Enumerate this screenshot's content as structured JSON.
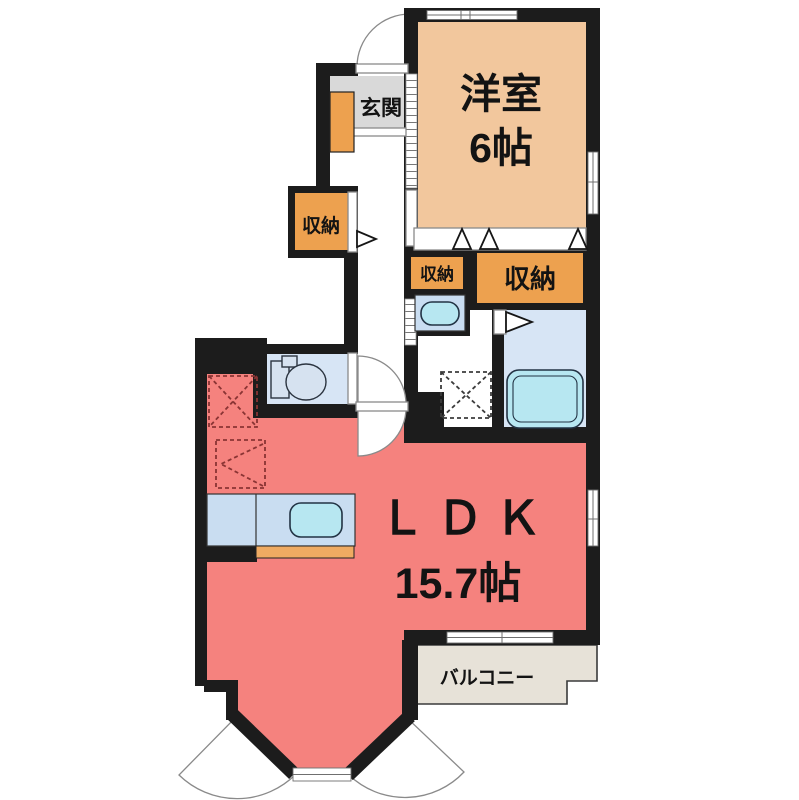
{
  "floorplan": {
    "rooms": {
      "bedroom": {
        "name": "洋室",
        "size": "6帖"
      },
      "ldk": {
        "name": "ＬＤＫ",
        "size": "15.7帖"
      },
      "entrance": {
        "label": "玄関"
      },
      "balcony": {
        "label": "バルコニー"
      },
      "closet_hall": {
        "label": "収納"
      },
      "closet_small": {
        "label": "収納"
      },
      "closet_wide": {
        "label": "収納"
      }
    },
    "colors": {
      "wall": "#1c1c1c",
      "bedroom_floor": "#f2c79d",
      "ldk_floor": "#f5827e",
      "closet": "#eda14f",
      "entrance_floor": "#d9d9d9",
      "balcony_floor": "#e7e2d8",
      "wet_floor": "#d7e5f5",
      "fixture_panel": "#c9ddf1",
      "fixture_water": "#b7e7f1",
      "counter_accent": "#efab62"
    }
  }
}
